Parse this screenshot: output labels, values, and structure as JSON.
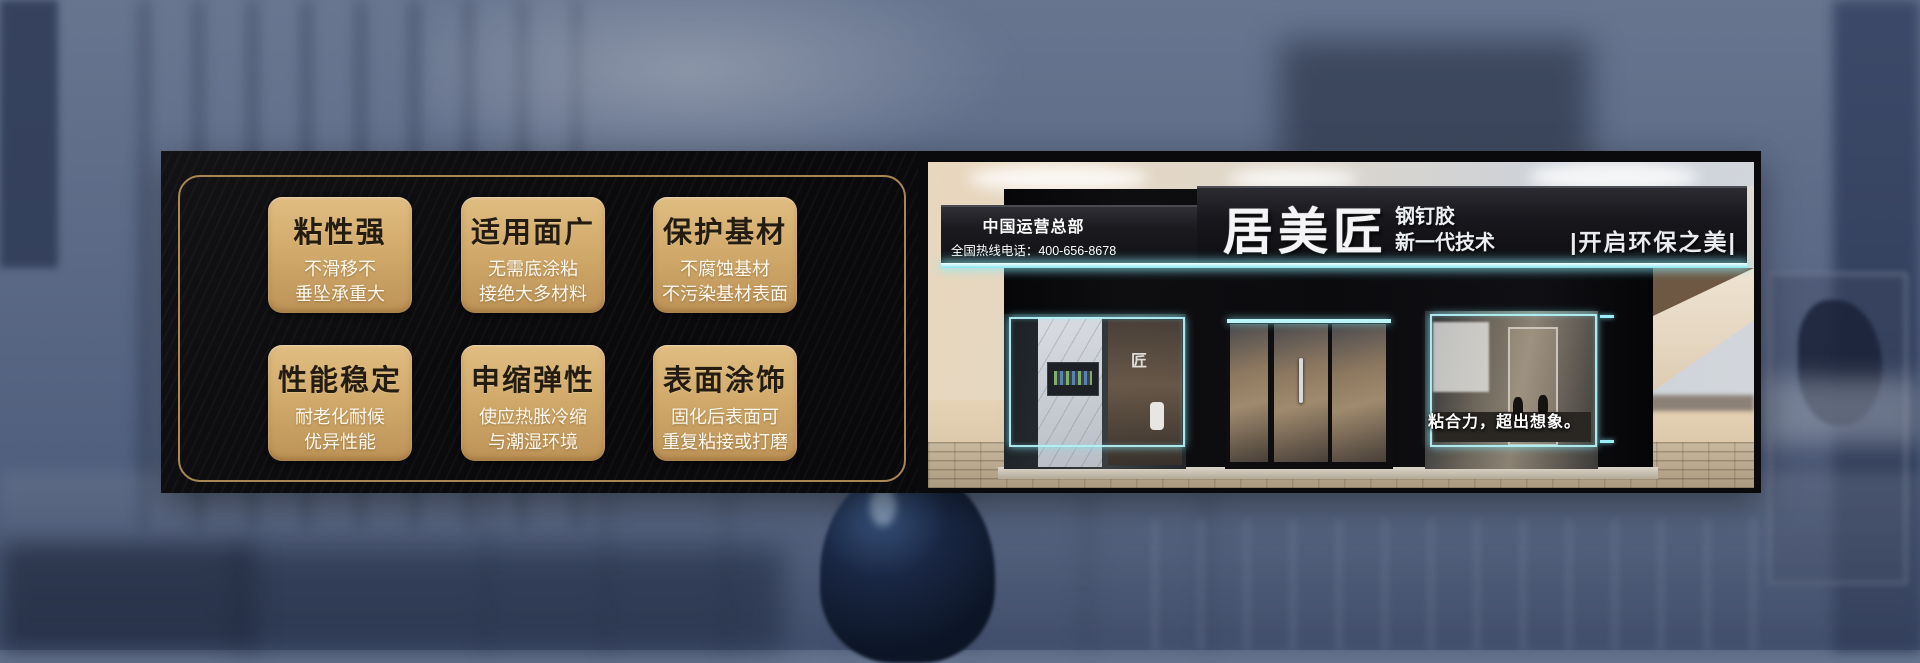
{
  "features": {
    "cards": [
      {
        "title": "粘性强",
        "line1": "不滑移不",
        "line2": "垂坠承重大"
      },
      {
        "title": "适用面广",
        "line1": "无需底涂粘",
        "line2": "接绝大多材料"
      },
      {
        "title": "保护基材",
        "line1": "不腐蚀基材",
        "line2": "不污染基材表面"
      },
      {
        "title": "性能稳定",
        "line1": "耐老化耐候",
        "line2": "优异性能"
      },
      {
        "title": "申缩弹性",
        "line1": "使应热胀冷缩",
        "line2": "与潮湿环境"
      },
      {
        "title": "表面涂饰",
        "line1": "固化后表面可",
        "line2": "重复粘接或打磨"
      }
    ]
  },
  "storefront": {
    "hq_line1": "中国运营总部",
    "hq_line2": "全国热线电话：400-656-8678",
    "brand": "居美匠",
    "brand_sub1": "钢钉胶",
    "brand_sub2": "新一代技术",
    "sign_slogan": "|开启环保之美|",
    "window_slogan": "粘合力，超出想象。",
    "window_logo": "匠"
  },
  "colors": {
    "gold_border": "#a98752",
    "card_gold": "#d2ab6c",
    "led_cyan": "#9beef5",
    "panel_black": "#0a0a0c"
  }
}
